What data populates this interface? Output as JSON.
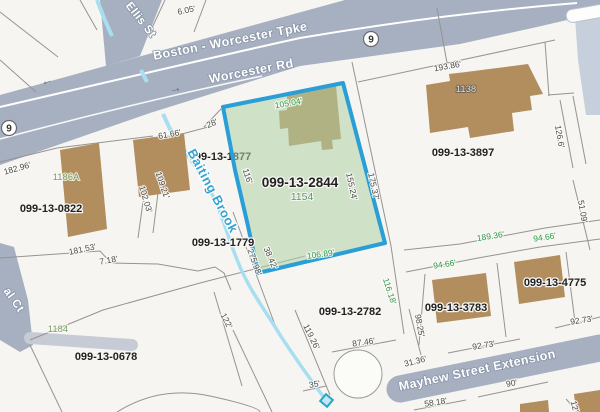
{
  "map": {
    "type": "gis-parcel-map",
    "selected_parcel": {
      "id": "099-13-2844",
      "address": "1154"
    },
    "colors": {
      "background": "#f6f5f2",
      "road": "#a6b0c1",
      "road_light": "#c6cfdc",
      "driveway": "#c6cbd6",
      "parcel_line": "#969390",
      "building": "#b28e5e",
      "highlight_fill": "#aecfa2",
      "highlight_border": "#2a9ed6",
      "water": "#a8dff0",
      "culvert": "#2aa6c6",
      "dim_green": "#2f9b45",
      "dim_dark": "#4b4b4b"
    }
  },
  "route_shields": [
    {
      "text": "9",
      "x": 9,
      "y": 128
    },
    {
      "text": "9",
      "x": 371,
      "y": 39
    }
  ],
  "road_arrows": [
    {
      "glyph": "←",
      "x": 48,
      "y": 84,
      "rot": -18
    },
    {
      "glyph": "→",
      "x": 176,
      "y": 92,
      "rot": -12
    }
  ],
  "road_labels": [
    {
      "text": "Boston - Worcester Tpke",
      "x": 231,
      "y": 45,
      "rot": -11,
      "size": 12.5
    },
    {
      "text": "Worcester Rd",
      "x": 252,
      "y": 75,
      "rot": -11,
      "size": 12.5
    },
    {
      "text": "Ellis St",
      "x": 138,
      "y": 22,
      "rot": 52,
      "size": 11.5
    },
    {
      "text": "Mayhew Street Extension",
      "x": 478,
      "y": 374,
      "rot": -12,
      "size": 12.5
    },
    {
      "text": "al Ct",
      "x": 11,
      "y": 302,
      "rot": 55,
      "size": 11.5
    }
  ],
  "water_labels": [
    {
      "text": "Baiting Brook",
      "x": 209,
      "y": 193,
      "rot": 62,
      "size": 13
    }
  ],
  "parcel_labels": [
    {
      "text": "099-13-1877",
      "x": 220,
      "y": 160,
      "under_highlight": true
    },
    {
      "text": "099-13-2844",
      "x": 300,
      "y": 187,
      "selected": true
    },
    {
      "text": "099-13-3897",
      "x": 463,
      "y": 156
    },
    {
      "text": "099-13-0822",
      "x": 51,
      "y": 212
    },
    {
      "text": "099-13-1779",
      "x": 223,
      "y": 246
    },
    {
      "text": "099-13-2782",
      "x": 350,
      "y": 315
    },
    {
      "text": "099-13-3783",
      "x": 456,
      "y": 311
    },
    {
      "text": "099-13-4775",
      "x": 555,
      "y": 286
    },
    {
      "text": "099-13-0678",
      "x": 106,
      "y": 360
    }
  ],
  "address_labels": [
    {
      "text": "1186A",
      "x": 66,
      "y": 180,
      "variant": "green"
    },
    {
      "text": "1184",
      "x": 58,
      "y": 332,
      "variant": "green"
    },
    {
      "text": "1154",
      "x": 302,
      "y": 200,
      "variant": "selected"
    },
    {
      "text": "1138",
      "x": 466,
      "y": 92,
      "variant": "light"
    }
  ],
  "dimension_labels": [
    {
      "text": "6.05'",
      "x": 187,
      "y": 13,
      "rot": -12,
      "variant": "dark"
    },
    {
      "text": "28'",
      "x": 213,
      "y": 126,
      "rot": -22,
      "variant": "dark"
    },
    {
      "text": "61.66'",
      "x": 170,
      "y": 137,
      "rot": -10,
      "variant": "dark"
    },
    {
      "text": "193.86'",
      "x": 448,
      "y": 69,
      "rot": -10,
      "variant": "dark"
    },
    {
      "text": "182.96'",
      "x": 18,
      "y": 171,
      "rot": -16,
      "variant": "dark"
    },
    {
      "text": "102.03'",
      "x": 143,
      "y": 200,
      "rot": 73,
      "variant": "dark"
    },
    {
      "text": "109.21'",
      "x": 160,
      "y": 186,
      "rot": 71,
      "variant": "dark"
    },
    {
      "text": "116'",
      "x": 245,
      "y": 177,
      "rot": 72,
      "variant": "dark"
    },
    {
      "text": "105.04'",
      "x": 289,
      "y": 106,
      "rot": -10,
      "variant": "green"
    },
    {
      "text": "155.24'",
      "x": 349,
      "y": 187,
      "rot": 78,
      "variant": "dark"
    },
    {
      "text": "175.37'",
      "x": 371,
      "y": 187,
      "rot": 78,
      "variant": "dark"
    },
    {
      "text": "106.89'",
      "x": 321,
      "y": 257,
      "rot": -8,
      "variant": "green"
    },
    {
      "text": "181.53'",
      "x": 83,
      "y": 252,
      "rot": -12,
      "variant": "dark"
    },
    {
      "text": "7.18'",
      "x": 109,
      "y": 263,
      "rot": -10,
      "variant": "dark"
    },
    {
      "text": "122'",
      "x": 224,
      "y": 322,
      "rot": 63,
      "variant": "dark"
    },
    {
      "text": "275.98'",
      "x": 252,
      "y": 263,
      "rot": 70,
      "variant": "dark"
    },
    {
      "text": "38.42'",
      "x": 268,
      "y": 259,
      "rot": 67,
      "variant": "dark"
    },
    {
      "text": "119.26'",
      "x": 309,
      "y": 338,
      "rot": 64,
      "variant": "dark"
    },
    {
      "text": "87.46'",
      "x": 364,
      "y": 345,
      "rot": -8,
      "variant": "dark"
    },
    {
      "text": "116.18'",
      "x": 387,
      "y": 292,
      "rot": 72,
      "variant": "green"
    },
    {
      "text": "98.25'",
      "x": 417,
      "y": 326,
      "rot": 80,
      "variant": "dark"
    },
    {
      "text": "31.36'",
      "x": 416,
      "y": 364,
      "rot": -14,
      "variant": "dark"
    },
    {
      "text": "35'",
      "x": 315,
      "y": 387,
      "rot": -10,
      "variant": "dark"
    },
    {
      "text": "58.18'",
      "x": 436,
      "y": 405,
      "rot": -9,
      "variant": "dark"
    },
    {
      "text": "90'",
      "x": 512,
      "y": 386,
      "rot": -9,
      "variant": "dark"
    },
    {
      "text": "92.73'",
      "x": 484,
      "y": 348,
      "rot": -9,
      "variant": "dark"
    },
    {
      "text": "92.73'",
      "x": 582,
      "y": 323,
      "rot": -9,
      "variant": "dark"
    },
    {
      "text": "189.36'",
      "x": 491,
      "y": 239,
      "rot": -9,
      "variant": "green"
    },
    {
      "text": "94.66'",
      "x": 445,
      "y": 267,
      "rot": -9,
      "variant": "green"
    },
    {
      "text": "94.66'",
      "x": 545,
      "y": 240,
      "rot": -9,
      "variant": "green"
    },
    {
      "text": "126.6'",
      "x": 557,
      "y": 137,
      "rot": 80,
      "variant": "dark"
    },
    {
      "text": "51.09'",
      "x": 580,
      "y": 212,
      "rot": 80,
      "variant": "dark"
    },
    {
      "text": "12'",
      "x": 572,
      "y": 407,
      "rot": 75,
      "variant": "dark"
    }
  ]
}
